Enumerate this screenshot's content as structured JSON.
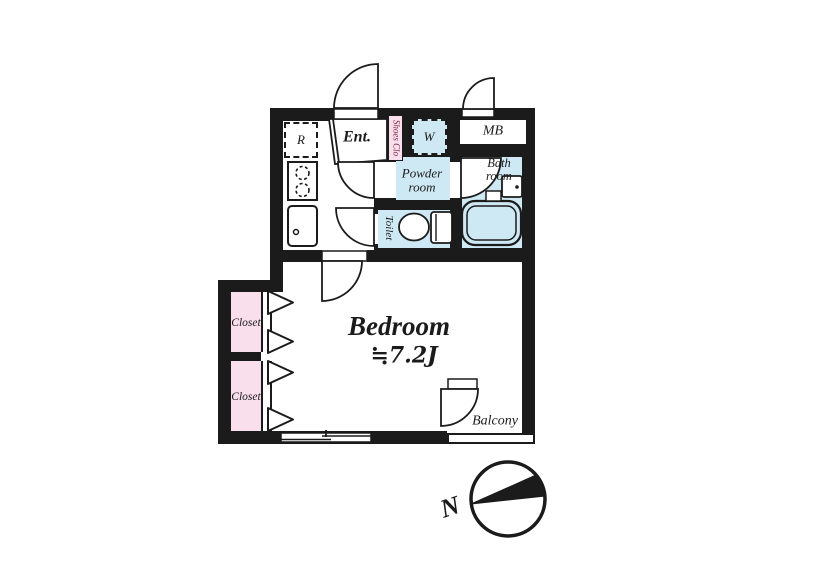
{
  "floorplan": {
    "labels": {
      "refrigerator": "R",
      "entrance": "Ent.",
      "shoes_closet": "Shoes Clo",
      "washer": "W",
      "meter_box": "MB",
      "powder_room": "Powder room",
      "bath_room": "Bath room",
      "toilet": "Toilet",
      "bedroom": "Bedroom",
      "bedroom_size": "≒7.2J",
      "closet_upper": "Closet",
      "closet_lower": "Closet",
      "balcony": "Balcony"
    },
    "compass": {
      "north": "N"
    },
    "colors": {
      "wall": "#1b1b1b",
      "wet_area_fill": "#cee9f4",
      "closet_fill": "#f9dfeb",
      "shoes_label_text": "#7b2340",
      "floor": "#ffffff"
    },
    "fixtures": [
      "entrance-door",
      "service-door",
      "powder-room-door",
      "toilet-door",
      "bedroom-door",
      "bathroom-door",
      "balcony-door",
      "stove",
      "kitchen-sink",
      "toilet-bowl",
      "bathtub",
      "washbasin",
      "sliding-window",
      "folding-closet-doors",
      "compass-rose"
    ]
  }
}
